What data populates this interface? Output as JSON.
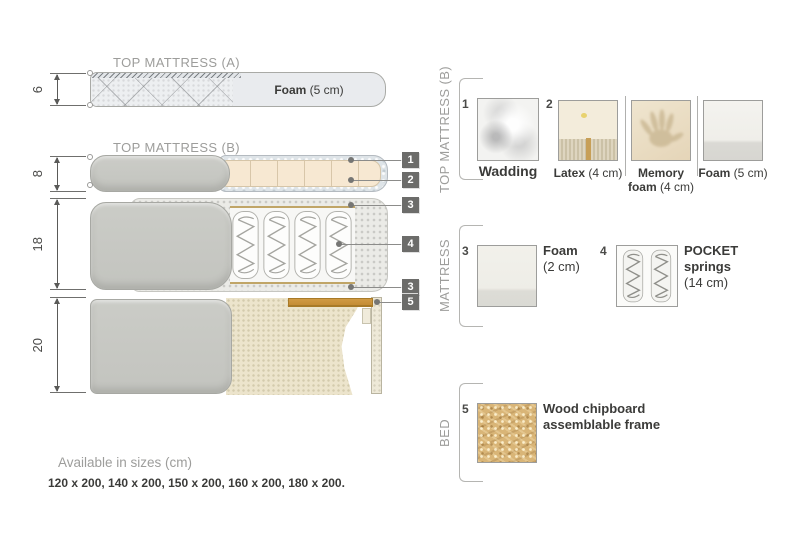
{
  "left": {
    "titleA": "TOP MATTRESS (A)",
    "titleB": "TOP MATTRESS (B)",
    "dims": {
      "a": "6",
      "b": "8",
      "mattress": "18",
      "bed": "20"
    },
    "foamA": {
      "bold": "Foam",
      "rest": " (5 cm)"
    },
    "badges": [
      "1",
      "2",
      "3",
      "4",
      "3",
      "5"
    ]
  },
  "legend": {
    "topB": {
      "label": "TOP MATTRESS (B)",
      "wadding": {
        "num": "1",
        "name": "Wadding"
      },
      "latex": {
        "num": "2",
        "bold": "Latex",
        "rest": " (4 cm)"
      },
      "memory": {
        "l1": "Memory",
        "l2bold": "foam",
        "l2rest": " (4 cm)"
      },
      "foam": {
        "bold": "Foam",
        "rest": " (5 cm)"
      }
    },
    "mattress": {
      "label": "MATTRESS",
      "foam": {
        "num": "3",
        "l1": "Foam",
        "l2": "(2 cm)"
      },
      "springs": {
        "num": "4",
        "l1": "POCKET",
        "l2": "springs",
        "l3": "(14 cm)"
      }
    },
    "bed": {
      "label": "BED",
      "frame": {
        "num": "5",
        "l1": "Wood chipboard",
        "l2": "assemblable frame"
      }
    }
  },
  "footer": {
    "title": "Available in sizes (cm)",
    "sizes": "120 x 200, 140 x 200, 150 x 200, 160 x 200, 180 x 200."
  },
  "colors": {
    "cover_gray": "#c7c8c3",
    "cream_foam": "#f7e8d2",
    "wadding_blue": "#dee4e8",
    "wood": "#c8913c",
    "badge": "#6c6c6a",
    "tan_line": "#c0a567"
  }
}
